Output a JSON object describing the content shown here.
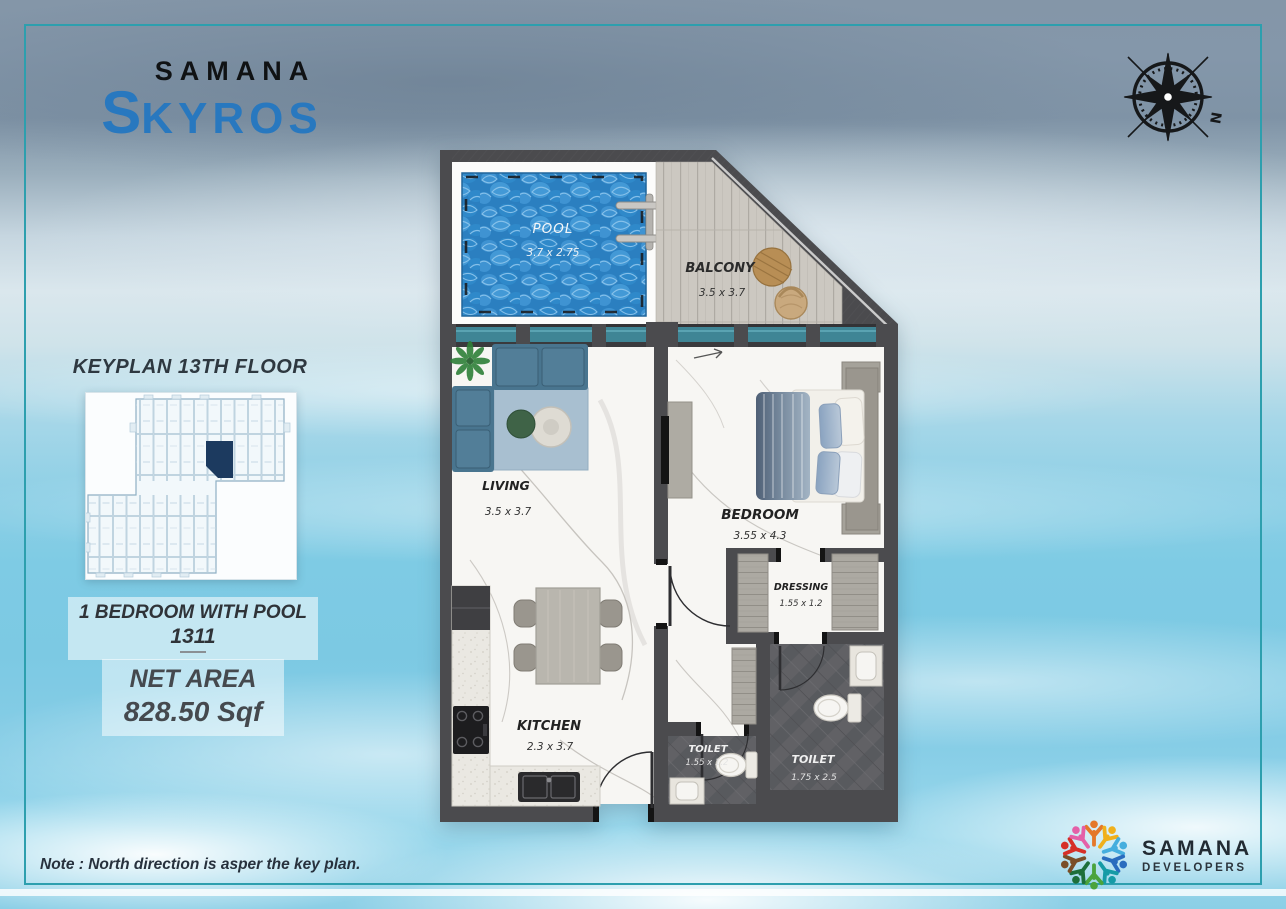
{
  "brand": {
    "name": "SAMANA",
    "product_first": "S",
    "product_rest": "KYROS"
  },
  "compass": {
    "north_label": "N"
  },
  "keyplan": {
    "title": "KEYPLAN 13TH FLOOR"
  },
  "unit": {
    "type": "1 BEDROOM WITH POOL",
    "number": "1311"
  },
  "net_area": {
    "label": "NET AREA",
    "value": "828.50 Sqf"
  },
  "note": "Note : North direction is asper the key plan.",
  "developer": {
    "name": "SAMANA",
    "tagline": "DEVELOPERS"
  },
  "rooms": {
    "pool": {
      "name": "POOL",
      "dims": "3.7  x 2.75"
    },
    "balcony": {
      "name": "BALCONY",
      "dims": "3.5  x 3.7"
    },
    "living": {
      "name": "LIVING",
      "dims": "3.5  x 3.7"
    },
    "bedroom": {
      "name": "BEDROOM",
      "dims": "3.55  x 4.3"
    },
    "kitchen": {
      "name": "KITCHEN",
      "dims": "2.3  x 3.7"
    },
    "dressing": {
      "name": "DRESSING",
      "dims": "1.55 x 1.2"
    },
    "toilet_small": {
      "name": "TOILET",
      "dims": "1.55 x 1.2"
    },
    "toilet_large": {
      "name": "TOILET",
      "dims": "1.75 x 2.5"
    }
  },
  "colors": {
    "frame_teal": "#2d9fae",
    "logo_blue": "#2878bf",
    "wall_gray": "#4b4b4e",
    "window_teal": "#3f8595",
    "pool_blue": "#2b7fc0",
    "keyplan_highlight": "#1c3a5f"
  }
}
